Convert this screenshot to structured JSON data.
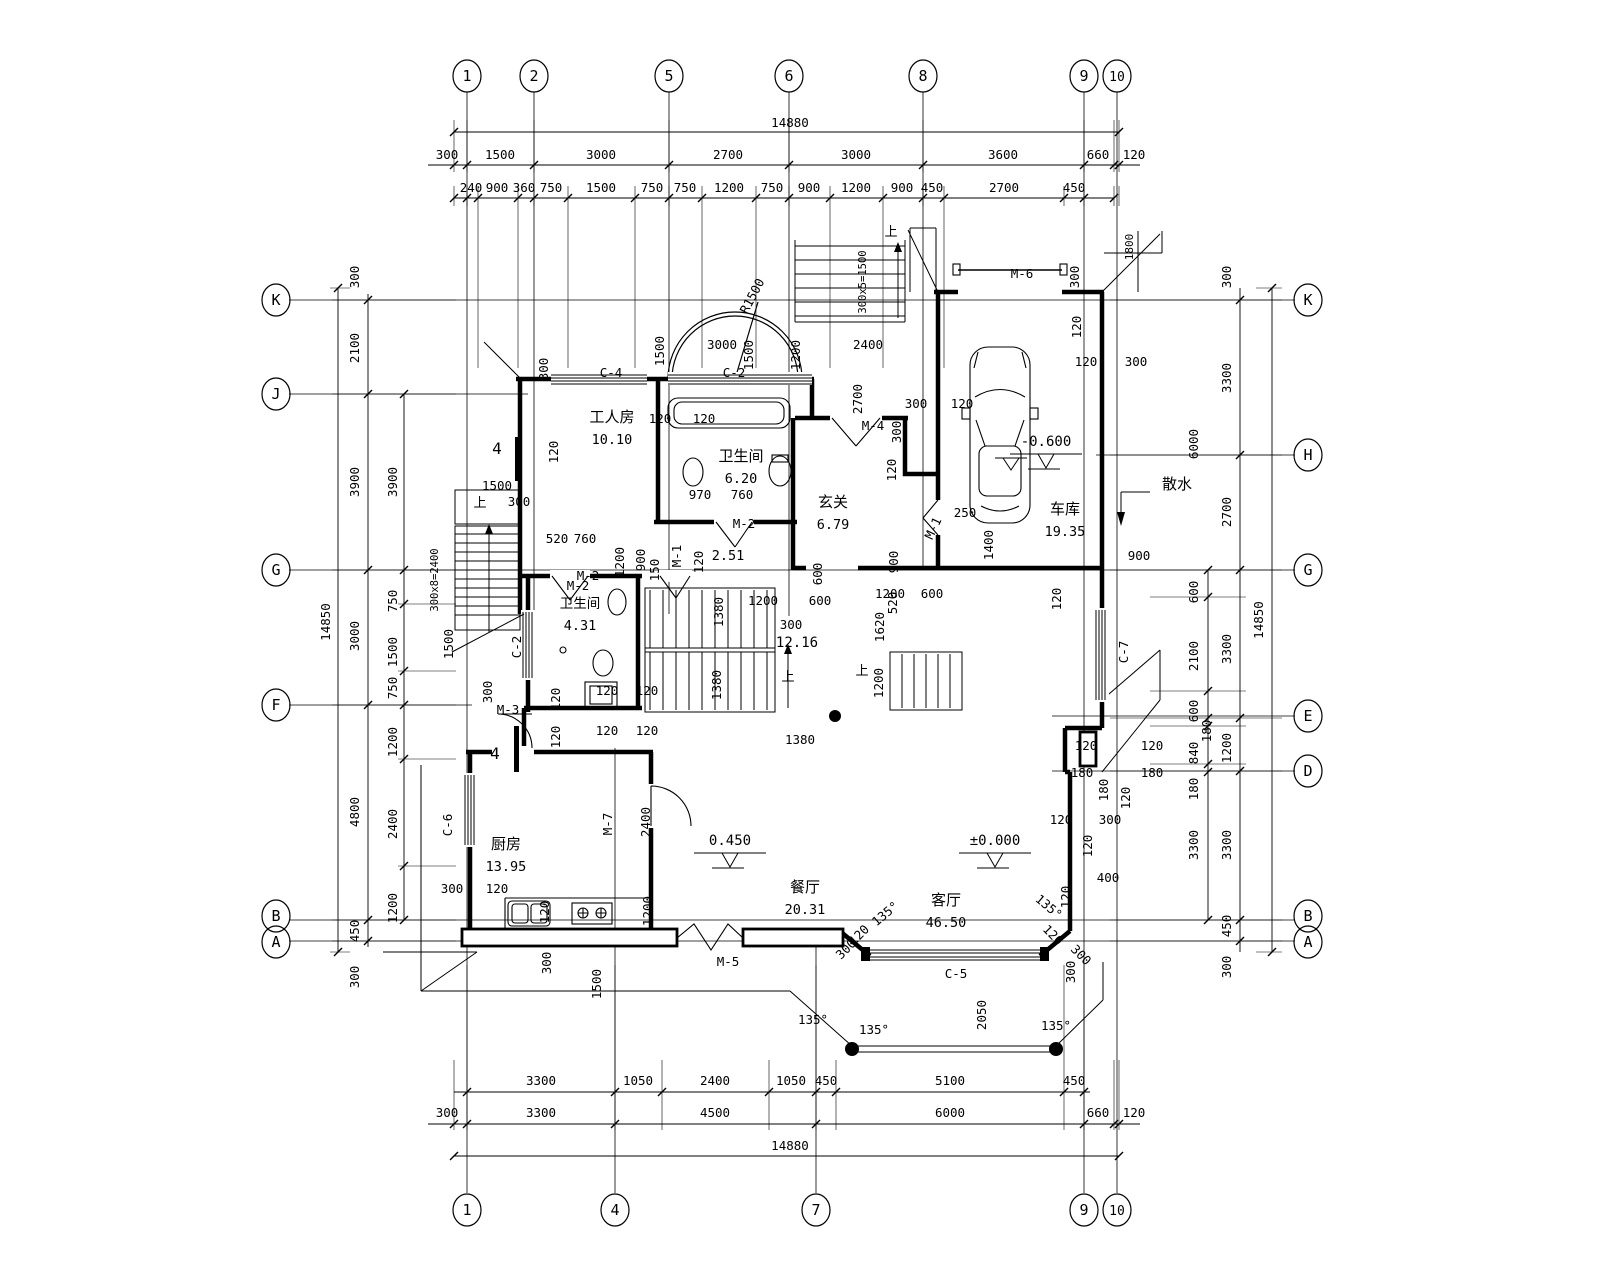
{
  "drawing_type": "architectural floor plan (first floor, villa)",
  "colors": {
    "line": "#000000",
    "background": "#ffffff"
  },
  "grid_bubbles": {
    "top": [
      {
        "label": "1",
        "x": 467
      },
      {
        "label": "2",
        "x": 534
      },
      {
        "label": "5",
        "x": 669
      },
      {
        "label": "6",
        "x": 789
      },
      {
        "label": "8",
        "x": 923
      },
      {
        "label": "9",
        "x": 1084
      },
      {
        "label": "10",
        "x": 1117
      }
    ],
    "bottom": [
      {
        "label": "1",
        "x": 467
      },
      {
        "label": "4",
        "x": 615
      },
      {
        "label": "7",
        "x": 816
      },
      {
        "label": "9",
        "x": 1084
      },
      {
        "label": "10",
        "x": 1117
      }
    ],
    "left": [
      {
        "label": "K",
        "y": 300
      },
      {
        "label": "J",
        "y": 394
      },
      {
        "label": "G",
        "y": 570
      },
      {
        "label": "F",
        "y": 705
      },
      {
        "label": "B",
        "y": 916
      },
      {
        "label": "A",
        "y": 942
      }
    ],
    "right": [
      {
        "label": "K",
        "y": 300
      },
      {
        "label": "H",
        "y": 455
      },
      {
        "label": "G",
        "y": 570
      },
      {
        "label": "E",
        "y": 716
      },
      {
        "label": "D",
        "y": 771
      },
      {
        "label": "B",
        "y": 916
      },
      {
        "label": "A",
        "y": 942
      }
    ]
  },
  "rooms": [
    {
      "name": "工人房",
      "area": "10.10",
      "x": 612,
      "y": 422
    },
    {
      "name": "卫生间",
      "area": "6.20",
      "x": 741,
      "y": 461
    },
    {
      "name": "玄关",
      "area": "6.79",
      "x": 833,
      "y": 507
    },
    {
      "name": "车库",
      "area": "19.35",
      "x": 1065,
      "y": 514
    },
    {
      "name": "卫生间",
      "area": "4.31",
      "x": 580,
      "y": 608,
      "s": 13.5
    },
    {
      "name": "厨房",
      "area": "13.95",
      "x": 506,
      "y": 849
    },
    {
      "name": "餐厅",
      "area": "20.31",
      "x": 805,
      "y": 892
    },
    {
      "name": "客厅",
      "area": "46.50",
      "x": 946,
      "y": 905
    }
  ],
  "elevations": [
    {
      "v": "±0.000",
      "x": 995,
      "y": 845
    },
    {
      "v": "0.450",
      "x": 730,
      "y": 845
    },
    {
      "v": "-0.600",
      "x": 1046,
      "y": 446
    }
  ],
  "labels": [
    {
      "t": "14880",
      "x": 790,
      "y": 127
    },
    {
      "t": "300",
      "x": 447,
      "y": 159
    },
    {
      "t": "1500",
      "x": 500,
      "y": 159
    },
    {
      "t": "3000",
      "x": 601,
      "y": 159
    },
    {
      "t": "2700",
      "x": 728,
      "y": 159
    },
    {
      "t": "3000",
      "x": 856,
      "y": 159
    },
    {
      "t": "3600",
      "x": 1003,
      "y": 159
    },
    {
      "t": "660",
      "x": 1098,
      "y": 159
    },
    {
      "t": "120",
      "x": 1134,
      "y": 159
    },
    {
      "t": "240",
      "x": 471,
      "y": 192
    },
    {
      "t": "900",
      "x": 497,
      "y": 192
    },
    {
      "t": "360",
      "x": 524,
      "y": 192
    },
    {
      "t": "750",
      "x": 551,
      "y": 192
    },
    {
      "t": "1500",
      "x": 601,
      "y": 192
    },
    {
      "t": "750",
      "x": 652,
      "y": 192
    },
    {
      "t": "750",
      "x": 685,
      "y": 192
    },
    {
      "t": "1200",
      "x": 729,
      "y": 192
    },
    {
      "t": "750",
      "x": 772,
      "y": 192
    },
    {
      "t": "900",
      "x": 809,
      "y": 192
    },
    {
      "t": "1200",
      "x": 856,
      "y": 192
    },
    {
      "t": "900",
      "x": 902,
      "y": 192
    },
    {
      "t": "450",
      "x": 932,
      "y": 192
    },
    {
      "t": "2700",
      "x": 1004,
      "y": 192
    },
    {
      "t": "450",
      "x": 1074,
      "y": 192
    },
    {
      "t": "3300",
      "x": 541,
      "y": 1085
    },
    {
      "t": "1050",
      "x": 638,
      "y": 1085
    },
    {
      "t": "2400",
      "x": 715,
      "y": 1085
    },
    {
      "t": "1050",
      "x": 791,
      "y": 1085
    },
    {
      "t": "450",
      "x": 826,
      "y": 1085
    },
    {
      "t": "5100",
      "x": 950,
      "y": 1085
    },
    {
      "t": "450",
      "x": 1074,
      "y": 1085
    },
    {
      "t": "300",
      "x": 447,
      "y": 1117
    },
    {
      "t": "3300",
      "x": 541,
      "y": 1117
    },
    {
      "t": "4500",
      "x": 715,
      "y": 1117
    },
    {
      "t": "6000",
      "x": 950,
      "y": 1117
    },
    {
      "t": "660",
      "x": 1098,
      "y": 1117
    },
    {
      "t": "120",
      "x": 1134,
      "y": 1117
    },
    {
      "t": "14880",
      "x": 790,
      "y": 1150
    },
    {
      "t": "300",
      "x": 359,
      "y": 277,
      "r": -90
    },
    {
      "t": "2100",
      "x": 359,
      "y": 348,
      "r": -90
    },
    {
      "t": "3900",
      "x": 359,
      "y": 482,
      "r": -90
    },
    {
      "t": "3900",
      "x": 397,
      "y": 482,
      "r": -90
    },
    {
      "t": "14850",
      "x": 330,
      "y": 622,
      "r": -90
    },
    {
      "t": "3000",
      "x": 359,
      "y": 636,
      "r": -90
    },
    {
      "t": "750",
      "x": 397,
      "y": 601,
      "r": -90
    },
    {
      "t": "1500",
      "x": 397,
      "y": 652,
      "r": -90
    },
    {
      "t": "750",
      "x": 397,
      "y": 688,
      "r": -90
    },
    {
      "t": "1200",
      "x": 397,
      "y": 742,
      "r": -90
    },
    {
      "t": "4800",
      "x": 359,
      "y": 812,
      "r": -90
    },
    {
      "t": "2400",
      "x": 397,
      "y": 824,
      "r": -90
    },
    {
      "t": "1200",
      "x": 397,
      "y": 908,
      "r": -90
    },
    {
      "t": "450",
      "x": 359,
      "y": 931,
      "r": -90
    },
    {
      "t": "300",
      "x": 359,
      "y": 977,
      "r": -90
    },
    {
      "t": "300",
      "x": 1231,
      "y": 277,
      "r": -90
    },
    {
      "t": "3300",
      "x": 1231,
      "y": 378,
      "r": -90
    },
    {
      "t": "6000",
      "x": 1198,
      "y": 444,
      "r": -90
    },
    {
      "t": "2700",
      "x": 1231,
      "y": 512,
      "r": -90
    },
    {
      "t": "3300",
      "x": 1231,
      "y": 649,
      "r": -90
    },
    {
      "t": "600",
      "x": 1198,
      "y": 592,
      "r": -90
    },
    {
      "t": "2100",
      "x": 1198,
      "y": 656,
      "r": -90
    },
    {
      "t": "600",
      "x": 1198,
      "y": 711,
      "r": -90
    },
    {
      "t": "180",
      "x": 1211,
      "y": 731,
      "r": -90
    },
    {
      "t": "840",
      "x": 1198,
      "y": 753,
      "r": -90
    },
    {
      "t": "180",
      "x": 1198,
      "y": 789,
      "r": -90
    },
    {
      "t": "1200",
      "x": 1231,
      "y": 748,
      "r": -90
    },
    {
      "t": "3300",
      "x": 1231,
      "y": 845,
      "r": -90
    },
    {
      "t": "3300",
      "x": 1198,
      "y": 845,
      "r": -90
    },
    {
      "t": "450",
      "x": 1231,
      "y": 926,
      "r": -90
    },
    {
      "t": "300",
      "x": 1231,
      "y": 967,
      "r": -90
    },
    {
      "t": "14850",
      "x": 1263,
      "y": 620,
      "r": -90
    },
    {
      "t": "1500",
      "x": 497,
      "y": 490
    },
    {
      "t": "300",
      "x": 519,
      "y": 506
    },
    {
      "t": "上",
      "x": 480,
      "y": 507,
      "k": "dir",
      "s": 13
    },
    {
      "t": "300x8=2400",
      "x": 438,
      "y": 580,
      "r": -90,
      "s": 10.5
    },
    {
      "t": "1500",
      "x": 453,
      "y": 644,
      "r": -90
    },
    {
      "t": "300",
      "x": 548,
      "y": 369,
      "r": -90
    },
    {
      "t": "120",
      "x": 558,
      "y": 452,
      "r": -90
    },
    {
      "t": "C-4",
      "x": 611,
      "y": 377,
      "k": "win"
    },
    {
      "t": "C-2",
      "x": 734,
      "y": 377,
      "k": "win"
    },
    {
      "t": "1500",
      "x": 664,
      "y": 351,
      "r": -90
    },
    {
      "t": "3000",
      "x": 722,
      "y": 349
    },
    {
      "t": "1500",
      "x": 753,
      "y": 355,
      "r": -90
    },
    {
      "t": "1200",
      "x": 800,
      "y": 355,
      "r": -90
    },
    {
      "t": "2400",
      "x": 868,
      "y": 349
    },
    {
      "t": "R1500",
      "x": 756,
      "y": 298,
      "r": -62
    },
    {
      "t": "300x5=1500",
      "x": 866,
      "y": 282,
      "r": -90,
      "s": 10.5
    },
    {
      "t": "2700",
      "x": 862,
      "y": 399,
      "r": -90
    },
    {
      "t": "M-4",
      "x": 873,
      "y": 430,
      "k": "door"
    },
    {
      "t": "300",
      "x": 916,
      "y": 408
    },
    {
      "t": "120",
      "x": 962,
      "y": 408
    },
    {
      "t": "300",
      "x": 901,
      "y": 432,
      "r": -90
    },
    {
      "t": "120",
      "x": 660,
      "y": 423
    },
    {
      "t": "120",
      "x": 704,
      "y": 423
    },
    {
      "t": "970",
      "x": 700,
      "y": 499
    },
    {
      "t": "760",
      "x": 742,
      "y": 499
    },
    {
      "t": "M-2",
      "x": 744,
      "y": 528,
      "k": "door"
    },
    {
      "t": "120",
      "x": 896,
      "y": 470,
      "r": -90
    },
    {
      "t": "520",
      "x": 557,
      "y": 543
    },
    {
      "t": "760",
      "x": 585,
      "y": 543
    },
    {
      "t": "M-2",
      "x": 578,
      "y": 590,
      "k": "door"
    },
    {
      "t": "1200",
      "x": 624,
      "y": 562,
      "r": -90
    },
    {
      "t": "900",
      "x": 645,
      "y": 560,
      "r": -90
    },
    {
      "t": "150",
      "x": 659,
      "y": 570,
      "r": -90
    },
    {
      "t": "M-1",
      "x": 681,
      "y": 556,
      "r": -90,
      "k": "door"
    },
    {
      "t": "120",
      "x": 703,
      "y": 562,
      "r": -90
    },
    {
      "t": "2.51",
      "x": 728,
      "y": 560,
      "k": "area",
      "s": 13.5
    },
    {
      "t": "600",
      "x": 822,
      "y": 574,
      "r": -90
    },
    {
      "t": "M-6",
      "x": 1022,
      "y": 278,
      "k": "door"
    },
    {
      "t": "1800",
      "x": 1133,
      "y": 247,
      "r": -90,
      "s": 11
    },
    {
      "t": "300",
      "x": 1079,
      "y": 277,
      "r": -90
    },
    {
      "t": "120",
      "x": 1081,
      "y": 327,
      "r": -90
    },
    {
      "t": "120",
      "x": 1086,
      "y": 366
    },
    {
      "t": "300",
      "x": 1136,
      "y": 366
    },
    {
      "t": "250",
      "x": 965,
      "y": 517
    },
    {
      "t": "1400",
      "x": 993,
      "y": 545,
      "r": -90
    },
    {
      "t": "900",
      "x": 898,
      "y": 562,
      "r": -90
    },
    {
      "t": "520",
      "x": 897,
      "y": 603,
      "r": -90
    },
    {
      "t": "M-1",
      "x": 937,
      "y": 530,
      "r": -65,
      "k": "door"
    },
    {
      "t": "散水",
      "x": 1177,
      "y": 489,
      "k": "txt",
      "s": 15
    },
    {
      "t": "900",
      "x": 1139,
      "y": 560
    },
    {
      "t": "120",
      "x": 1061,
      "y": 599,
      "r": -90
    },
    {
      "t": "C-7",
      "x": 1128,
      "y": 652,
      "r": -90,
      "k": "win"
    },
    {
      "t": "1200",
      "x": 763,
      "y": 605
    },
    {
      "t": "600",
      "x": 820,
      "y": 605
    },
    {
      "t": "1200",
      "x": 890,
      "y": 598
    },
    {
      "t": "600",
      "x": 932,
      "y": 598
    },
    {
      "t": "300",
      "x": 791,
      "y": 629
    },
    {
      "t": "12.16",
      "x": 797,
      "y": 647,
      "k": "area",
      "s": 14
    },
    {
      "t": "1620",
      "x": 884,
      "y": 627,
      "r": -90
    },
    {
      "t": "1200",
      "x": 883,
      "y": 683,
      "r": -90
    },
    {
      "t": "1380",
      "x": 723,
      "y": 612,
      "r": -90
    },
    {
      "t": "1380",
      "x": 721,
      "y": 685,
      "r": -90
    },
    {
      "t": "1380",
      "x": 800,
      "y": 744
    },
    {
      "t": "上",
      "x": 788,
      "y": 681,
      "k": "dir",
      "s": 13
    },
    {
      "t": "上",
      "x": 862,
      "y": 675,
      "k": "dir",
      "s": 13
    },
    {
      "t": "上",
      "x": 891,
      "y": 236,
      "k": "dir",
      "s": 13
    },
    {
      "t": "120",
      "x": 607,
      "y": 695
    },
    {
      "t": "120",
      "x": 647,
      "y": 695
    },
    {
      "t": "120",
      "x": 607,
      "y": 735
    },
    {
      "t": "120",
      "x": 647,
      "y": 735
    },
    {
      "t": "120",
      "x": 560,
      "y": 699,
      "r": -90
    },
    {
      "t": "120",
      "x": 560,
      "y": 737,
      "r": -90
    },
    {
      "t": "M-2",
      "x": 588,
      "y": 580,
      "k": "door"
    },
    {
      "t": "C-2",
      "x": 521,
      "y": 647,
      "r": -90,
      "k": "win"
    },
    {
      "t": "M-3",
      "x": 508,
      "y": 714,
      "k": "door"
    },
    {
      "t": "300",
      "x": 492,
      "y": 692,
      "r": -90
    },
    {
      "t": "4",
      "x": 497,
      "y": 454,
      "k": "sec",
      "s": 16
    },
    {
      "t": "4",
      "x": 495,
      "y": 759,
      "k": "sec",
      "s": 16
    },
    {
      "t": "C-6",
      "x": 452,
      "y": 825,
      "r": -90,
      "k": "win"
    },
    {
      "t": "M-7",
      "x": 612,
      "y": 824,
      "r": -90,
      "k": "door"
    },
    {
      "t": "2400",
      "x": 650,
      "y": 822,
      "r": -90
    },
    {
      "t": "300",
      "x": 452,
      "y": 893
    },
    {
      "t": "120",
      "x": 497,
      "y": 893
    },
    {
      "t": "120",
      "x": 549,
      "y": 912,
      "r": -90
    },
    {
      "t": "1200",
      "x": 652,
      "y": 911,
      "r": -90
    },
    {
      "t": "300",
      "x": 551,
      "y": 963,
      "r": -90
    },
    {
      "t": "1500",
      "x": 601,
      "y": 984,
      "r": -90
    },
    {
      "t": "M-5",
      "x": 728,
      "y": 966,
      "k": "door"
    },
    {
      "t": "C-5",
      "x": 956,
      "y": 978,
      "k": "win"
    },
    {
      "t": "135°",
      "x": 888,
      "y": 917,
      "r": -40
    },
    {
      "t": "135°",
      "x": 1046,
      "y": 910,
      "r": 40
    },
    {
      "t": "135°",
      "x": 813,
      "y": 1024
    },
    {
      "t": "135°",
      "x": 874,
      "y": 1034
    },
    {
      "t": "135°",
      "x": 1056,
      "y": 1030
    },
    {
      "t": "120",
      "x": 862,
      "y": 938,
      "r": -45
    },
    {
      "t": "120",
      "x": 1050,
      "y": 938,
      "r": 45
    },
    {
      "t": "300",
      "x": 849,
      "y": 952,
      "r": -45
    },
    {
      "t": "300",
      "x": 1078,
      "y": 958,
      "r": 45
    },
    {
      "t": "2050",
      "x": 986,
      "y": 1015,
      "r": -90
    },
    {
      "t": "300",
      "x": 1075,
      "y": 972,
      "r": -90
    },
    {
      "t": "400",
      "x": 1108,
      "y": 882
    },
    {
      "t": "120",
      "x": 1070,
      "y": 897,
      "r": -90
    },
    {
      "t": "120",
      "x": 1061,
      "y": 824
    },
    {
      "t": "300",
      "x": 1110,
      "y": 824
    },
    {
      "t": "120",
      "x": 1086,
      "y": 750
    },
    {
      "t": "120",
      "x": 1152,
      "y": 750
    },
    {
      "t": "180",
      "x": 1082,
      "y": 777
    },
    {
      "t": "180",
      "x": 1152,
      "y": 777
    },
    {
      "t": "180",
      "x": 1108,
      "y": 790,
      "r": -90
    },
    {
      "t": "120",
      "x": 1130,
      "y": 798,
      "r": -90
    },
    {
      "t": "120",
      "x": 1092,
      "y": 846,
      "r": -90
    }
  ]
}
